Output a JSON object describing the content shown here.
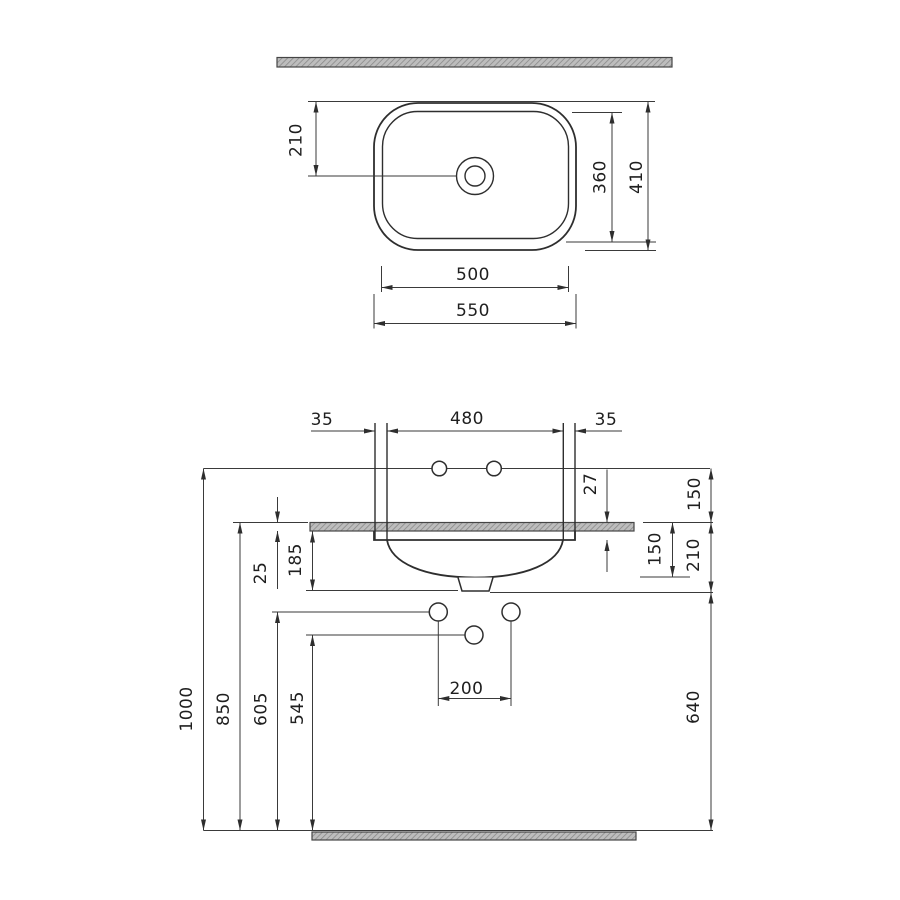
{
  "drawing": {
    "kind": "washbasin technical installation drawing",
    "views": [
      "top view",
      "front installation view"
    ]
  },
  "top_view": {
    "drain_offset": "210",
    "inner_depth": "360",
    "outer_depth": "410",
    "inner_width": "500",
    "outer_width": "550"
  },
  "front_view": {
    "margin_left": "35",
    "faucet_span": "480",
    "margin_right": "35",
    "rim_drop": "27",
    "wall_to_counter": "150",
    "basin_depth": "150",
    "counter_to_trap": "210",
    "counter_thickness": "25",
    "basin_overall": "185",
    "h_total": "1000",
    "h_counter": "850",
    "h_supply": "605",
    "h_trap": "545",
    "h_drain_line": "640",
    "drain_spacing": "200"
  }
}
